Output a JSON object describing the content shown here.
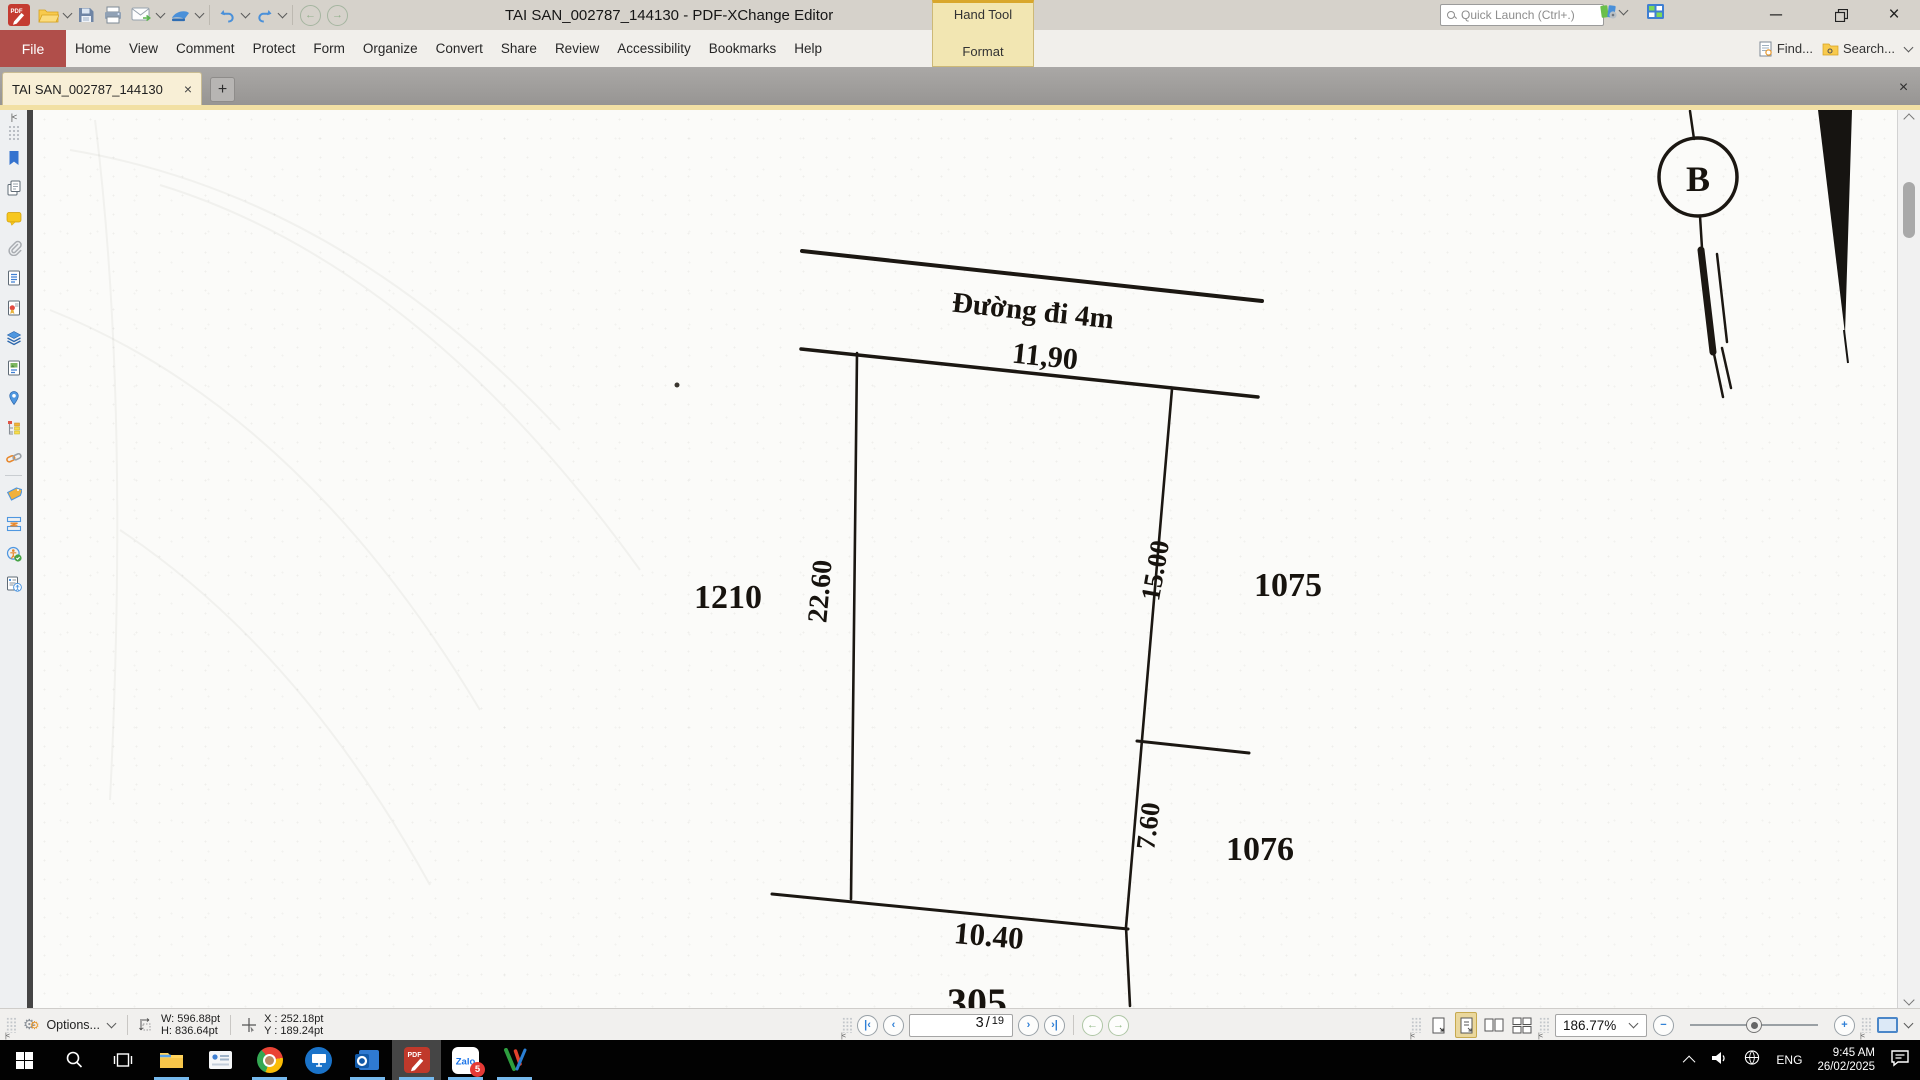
{
  "titlebar": {
    "title": "TAI SAN_002787_144130 - PDF-XChange Editor",
    "quick_launch_placeholder": "Quick Launch (Ctrl+.)",
    "hand_tool_label": "Hand Tool",
    "format_label": "Format"
  },
  "menubar": {
    "file": "File",
    "items": [
      "Home",
      "View",
      "Comment",
      "Protect",
      "Form",
      "Organize",
      "Convert",
      "Share",
      "Review",
      "Accessibility",
      "Bookmarks",
      "Help"
    ],
    "find_label": "Find...",
    "search_label": "Search..."
  },
  "tabbar": {
    "active_tab": "TAI SAN_002787_144130"
  },
  "sidebar": {
    "icons": [
      "bookmarks",
      "thumbnails",
      "comments",
      "attachments",
      "fields",
      "signatures",
      "layers",
      "content",
      "destinations",
      "structure",
      "links",
      "tags",
      "content-order",
      "accessibility-check",
      "accessibility-tags"
    ]
  },
  "drawing": {
    "road_label": "Đường đi 4m",
    "top_width": "11,90",
    "left_length": "22.60",
    "right_upper_length": "15.00",
    "right_lower_length": "7.60",
    "bottom_width": "10.40",
    "parcel_left_id": "1210",
    "parcel_right_upper_id": "1075",
    "parcel_right_lower_id": "1076",
    "parcel_bottom_id": "305",
    "node_label": "B"
  },
  "statusbar": {
    "options_label": "Options...",
    "width_readout": "W: 596.88pt",
    "height_readout": "H: 836.64pt",
    "x_readout": "X : 252.18pt",
    "y_readout": "Y : 189.24pt",
    "page_current": "3",
    "page_separator": "/",
    "page_total": "19",
    "zoom_level": "186.77%"
  },
  "taskbar": {
    "language": "ENG",
    "time": "9:45 AM",
    "date": "26/02/2025",
    "zalo_badge": "5"
  }
}
